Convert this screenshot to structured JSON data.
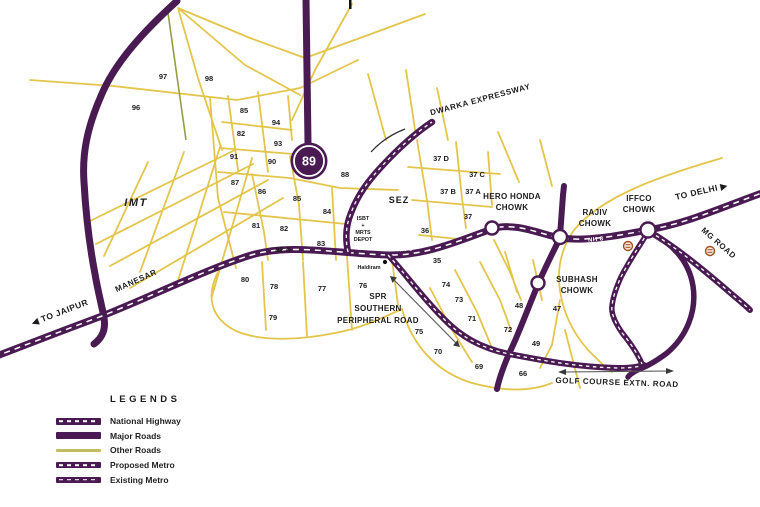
{
  "map": {
    "badge": {
      "text": "89"
    },
    "area_labels": [
      {
        "text": "IMT",
        "x": 136,
        "y": 206,
        "style": "imt"
      },
      {
        "text": "SEZ",
        "x": 399,
        "y": 203,
        "style": "sez"
      }
    ],
    "sectors": [
      {
        "text": "97",
        "x": 163,
        "y": 79
      },
      {
        "text": "98",
        "x": 209,
        "y": 81
      },
      {
        "text": "96",
        "x": 136,
        "y": 110
      },
      {
        "text": "85",
        "x": 244,
        "y": 113
      },
      {
        "text": "94",
        "x": 276,
        "y": 125
      },
      {
        "text": "82",
        "x": 241,
        "y": 136
      },
      {
        "text": "93",
        "x": 278,
        "y": 146
      },
      {
        "text": "91",
        "x": 234,
        "y": 159
      },
      {
        "text": "90",
        "x": 272,
        "y": 164
      },
      {
        "text": "88",
        "x": 345,
        "y": 177
      },
      {
        "text": "87",
        "x": 235,
        "y": 185
      },
      {
        "text": "86",
        "x": 262,
        "y": 194
      },
      {
        "text": "85",
        "x": 297,
        "y": 201
      },
      {
        "text": "84",
        "x": 327,
        "y": 214
      },
      {
        "text": "81",
        "x": 256,
        "y": 228
      },
      {
        "text": "82",
        "x": 284,
        "y": 231
      },
      {
        "text": "83",
        "x": 321,
        "y": 246
      },
      {
        "text": "82 A",
        "x": 283,
        "y": 252
      },
      {
        "text": "80",
        "x": 245,
        "y": 282
      },
      {
        "text": "78",
        "x": 274,
        "y": 289
      },
      {
        "text": "77",
        "x": 322,
        "y": 291
      },
      {
        "text": "76",
        "x": 363,
        "y": 288
      },
      {
        "text": "79",
        "x": 273,
        "y": 320
      },
      {
        "text": "37 D",
        "x": 441,
        "y": 161
      },
      {
        "text": "37 C",
        "x": 477,
        "y": 177
      },
      {
        "text": "37 B",
        "x": 448,
        "y": 194
      },
      {
        "text": "37 A",
        "x": 473,
        "y": 194
      },
      {
        "text": "37",
        "x": 468,
        "y": 219
      },
      {
        "text": "36",
        "x": 425,
        "y": 233
      },
      {
        "text": "35",
        "x": 437,
        "y": 263
      },
      {
        "text": "74",
        "x": 446,
        "y": 287
      },
      {
        "text": "73",
        "x": 459,
        "y": 302
      },
      {
        "text": "71",
        "x": 472,
        "y": 321
      },
      {
        "text": "75",
        "x": 419,
        "y": 334
      },
      {
        "text": "70",
        "x": 438,
        "y": 354
      },
      {
        "text": "69",
        "x": 479,
        "y": 369
      },
      {
        "text": "72",
        "x": 508,
        "y": 332
      },
      {
        "text": "48",
        "x": 519,
        "y": 308
      },
      {
        "text": "47",
        "x": 557,
        "y": 311
      },
      {
        "text": "49",
        "x": 536,
        "y": 346
      },
      {
        "text": "66",
        "x": 523,
        "y": 376
      }
    ],
    "landmarks": [
      {
        "lines": [
          "HERO HONDA",
          "CHOWK"
        ],
        "x": 512,
        "y": 199,
        "lh": 11
      },
      {
        "lines": [
          "RAJIV",
          "CHOWK"
        ],
        "x": 595,
        "y": 215,
        "lh": 11
      },
      {
        "lines": [
          "IFFCO",
          "CHOWK"
        ],
        "x": 639,
        "y": 201,
        "lh": 11
      },
      {
        "lines": [
          "SUBHASH",
          "CHOWK"
        ],
        "x": 577,
        "y": 282,
        "lh": 11
      },
      {
        "lines": [
          "SPR",
          "SOUTHERN",
          "PERIPHERAL ROAD"
        ],
        "x": 378,
        "y": 299,
        "lh": 12
      }
    ],
    "depot": {
      "lines": [
        "ISBT",
        "+",
        "MRTS",
        "DEPOT"
      ],
      "x": 363,
      "y": 220,
      "lh": 7
    },
    "poi": {
      "text": "Haldiram",
      "x": 369,
      "y": 269
    },
    "road_labels": [
      {
        "text": "DWARKA EXPRESSWAY",
        "x": 481,
        "y": 102,
        "rot": -15
      },
      {
        "text": "MANESAR",
        "x": 137,
        "y": 283,
        "rot": -24
      },
      {
        "text": "MG ROAD",
        "x": 717,
        "y": 245,
        "rot": 41
      },
      {
        "text": "GOLF COURSE EXTN. ROAD",
        "x": 617,
        "y": 385,
        "rot": 2
      }
    ],
    "nh8_labels": [
      {
        "text": "NH 8",
        "x": 405,
        "y": 251,
        "rot": -3
      },
      {
        "text": "NH 8",
        "x": 596,
        "y": 241,
        "rot": -6
      }
    ],
    "direction_labels": [
      {
        "text": "TO JAIPUR",
        "arrow": "left",
        "x": 61,
        "y": 315,
        "rot": -21
      },
      {
        "text": "TO DELHI",
        "arrow": "right",
        "x": 702,
        "y": 194,
        "rot": -13
      }
    ]
  },
  "legend": {
    "title": "LEGENDS",
    "items": [
      {
        "label": "National Highway",
        "style": "national-highway",
        "dashed": true
      },
      {
        "label": "Major Roads",
        "style": "major-road",
        "dashed": false
      },
      {
        "label": "Other Roads",
        "style": "other-road",
        "dashed": false
      },
      {
        "label": "Proposed Metro",
        "style": "proposed-metro",
        "dashed": true
      },
      {
        "label": "Existing Metro",
        "style": "existing-metro",
        "dashed": true
      }
    ]
  },
  "colors": {
    "road_purple": "#4a1a52",
    "road_yellow": "#e3c54b",
    "other_road_green": "#93a03d",
    "metro_station": "#a1501f"
  }
}
